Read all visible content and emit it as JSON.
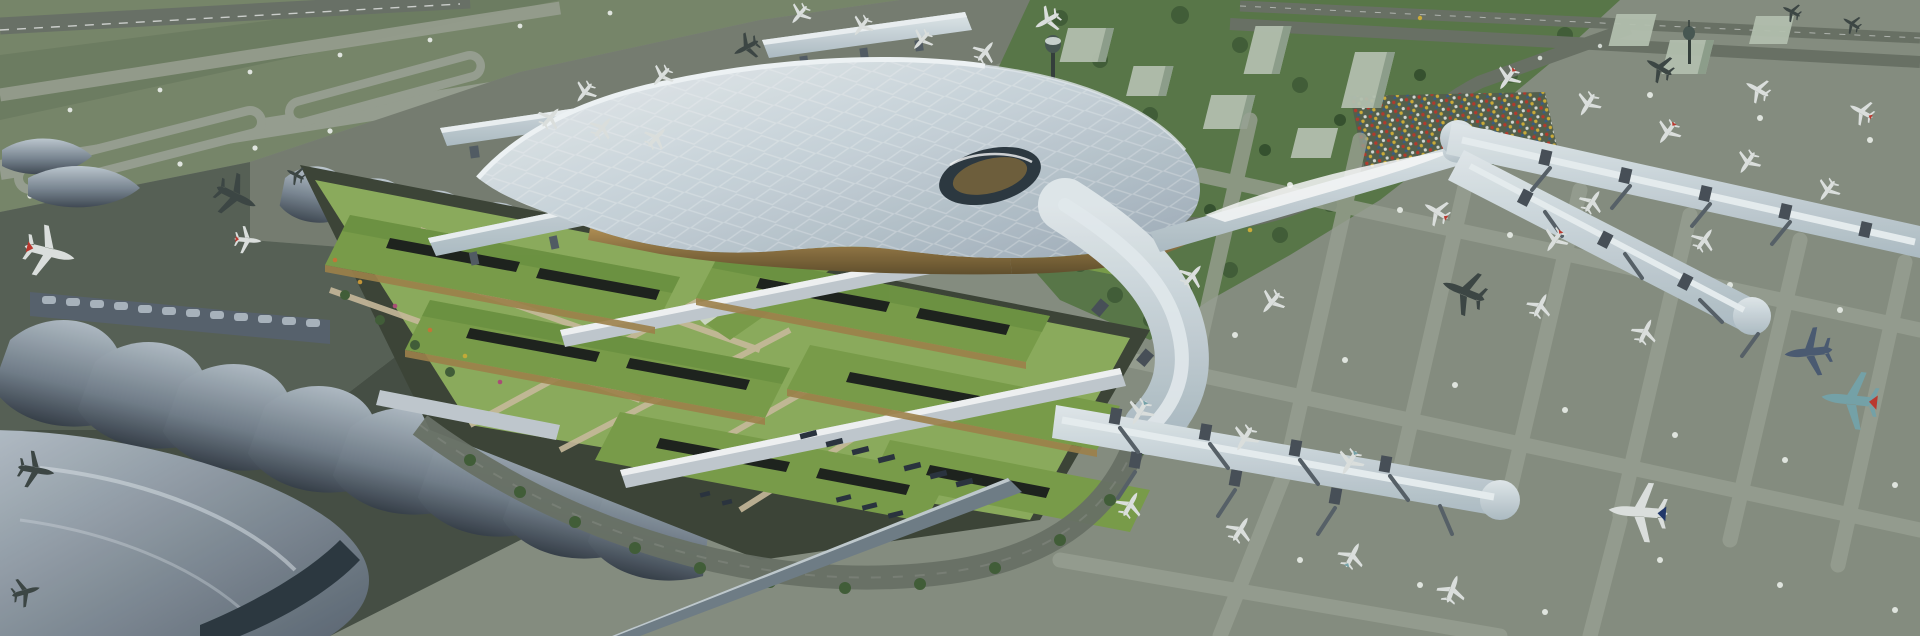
{
  "scene": {
    "type": "3d-architectural-rendering",
    "view": "aerial-oblique",
    "subject": "international airport terminal complex",
    "visible_text": "",
    "description": "Aerial rendering of a large airport: a sweeping silver lattice-shell terminal roof with a dark glass eye skylight, a ground transportation center of green-roofed halls and lawns, an older terminal with undulating wave roofs at left, linear boarding piers with jet bridges and parked airliners on concrete aprons at right, grass airfield with runways and taxiway loops at upper left, and a landside zone with trees, glass office blocks, an elevated approach road, a full car park and control towers at upper right."
  },
  "palette": {
    "apron_east": "#8a9184",
    "apron_north": "#7a8174",
    "apron_west": "#5a6358",
    "apron_west_dark": "#485146",
    "grass": "#7b8a6d",
    "grass_dark": "#69785c",
    "runway": "#6d746a",
    "taxiway": "#9ca394",
    "lane_marking": "#9fa697",
    "dot_light": "#e9ede6",
    "vegetation": "#5c7a4a",
    "tree": "#44603a",
    "tree_dark": "#35502e",
    "building_glass": "#b9c5b3",
    "building_side": "#8fa08c",
    "road": "#6d7468",
    "parking_lot": "#57624f",
    "platform": "#3f4639",
    "lawn": "#90b05f",
    "green_roof": "#7da14b",
    "green_roof_dark": "#69903f",
    "path_tan": "#cfc0a0",
    "skylight_dark": "#20241f",
    "canopy_silver": "#c6ced4",
    "facade_gold": "#a3854d",
    "facade_gold_dark": "#6f5a33",
    "roof_light": "#eef3f6",
    "roof_mid": "#c5d1d9",
    "roof_dark": "#9dabb8",
    "wave_light": "#c0cad3",
    "wave_mid": "#7c8895",
    "wave_dark": "#3a424c",
    "glass_dark": "#2e3a42",
    "eye_gold": "#8a6f3e",
    "wall_glass": "#73808a",
    "plane_light": "#e3e7e4",
    "plane_dark": "#3f4846",
    "plane_navy": "#4e5d75",
    "plane_teal": "#79a7ad",
    "tail_red": "#c23a30",
    "tail_navy": "#233a6e",
    "bus": "#2c3540",
    "car_red": "#b93c2e",
    "car_yellow": "#d2b13c",
    "car_white": "#dadfd9",
    "car_blue": "#3a5f8a"
  },
  "objects": {
    "main_terminal": "curved lattice-shell roof with diamond perforation and oval glass skylight",
    "ground_transport_center": "green-roofed halls with rooftop lawns, skylight strips and tan walkways",
    "west_terminal": "existing terminal with rows of undulating metal wave roofs",
    "piers": "linear boarding piers with rounded ends, gate boxes and jet bridges",
    "north_satellites": "two linear remote concourses with nose-in narrowbody aircraft",
    "aircraft": "parked and taxiing airliners including widebody jets with red, teal and navy tails",
    "landside": "elevated curving approach road, dense car park, glass office blocks, tree belt, two control towers",
    "airfield": "grass field with runway, parallel taxiways, racetrack loops and white edge lights"
  }
}
